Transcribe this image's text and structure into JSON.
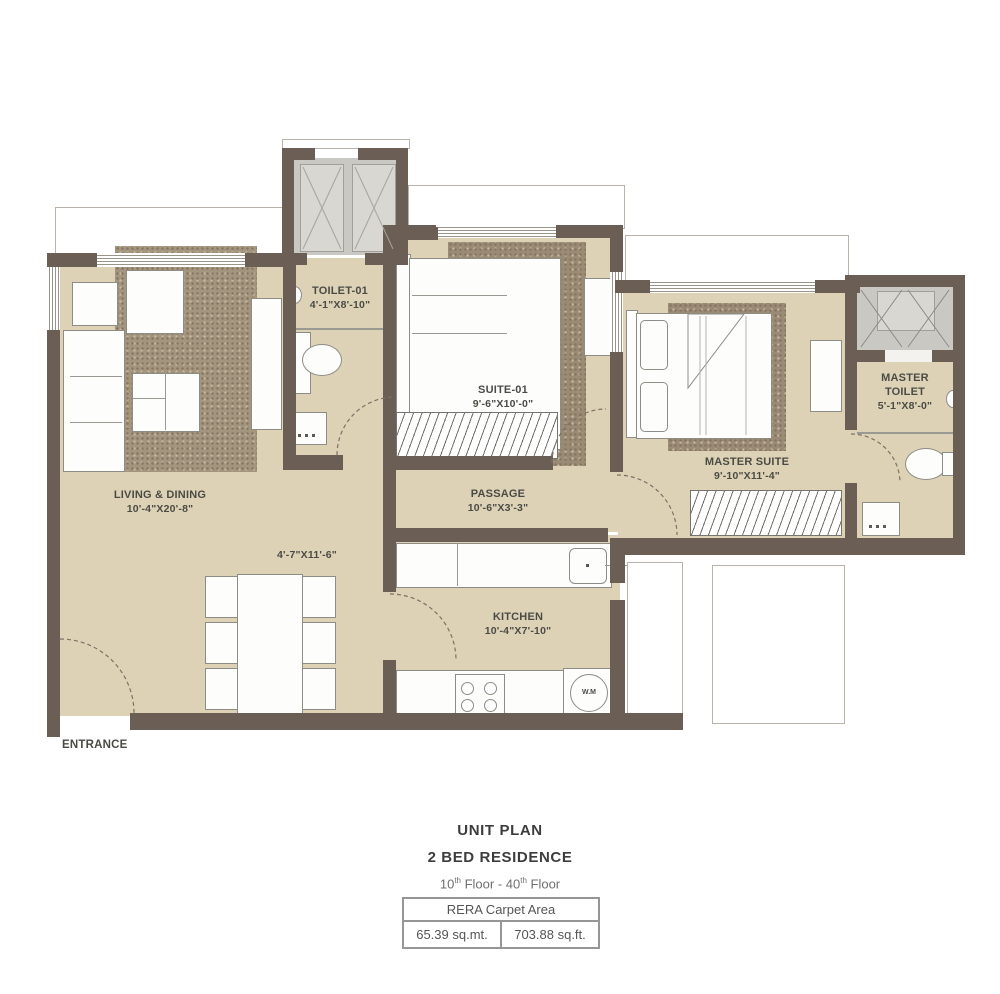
{
  "plan": {
    "entrance": "ENTRANCE",
    "rooms": {
      "living": {
        "name": "LIVING & DINING",
        "dims": "10'-4\"X20'-8\""
      },
      "dining": {
        "dims": "4'-7\"X11'-6\""
      },
      "toilet01": {
        "name": "TOILET-01",
        "dims": "4'-1\"X8'-10\""
      },
      "suite01": {
        "name": "SUITE-01",
        "dims": "9'-6\"X10'-0\""
      },
      "passage": {
        "name": "PASSAGE",
        "dims": "10'-6\"X3'-3\""
      },
      "master_suite": {
        "name": "MASTER SUITE",
        "dims": "9'-10\"X11'-4\""
      },
      "master_toilet": {
        "name": "MASTER TOILET",
        "dims": "5'-1\"X8'-0\""
      },
      "kitchen": {
        "name": "KITCHEN",
        "dims": "10'-4\"X7'-10\""
      }
    },
    "appliances": {
      "washing_machine": "W.M"
    }
  },
  "footer": {
    "title": "UNIT PLAN",
    "subtitle": "2 BED RESIDENCE",
    "floors": {
      "p1": "10",
      "s1": "th",
      "p2": " Floor - 40",
      "s2": "th",
      "p3": " Floor"
    },
    "rera": {
      "header": "RERA Carpet Area",
      "sqmt": "65.39 sq.mt.",
      "sqft": "703.88 sq.ft."
    }
  },
  "colors": {
    "wall": "#6b5e55",
    "floor": "#ddd2b6",
    "rug": "#a4957f",
    "shaft": "#c9c8c3",
    "label": "#4b4b45"
  }
}
